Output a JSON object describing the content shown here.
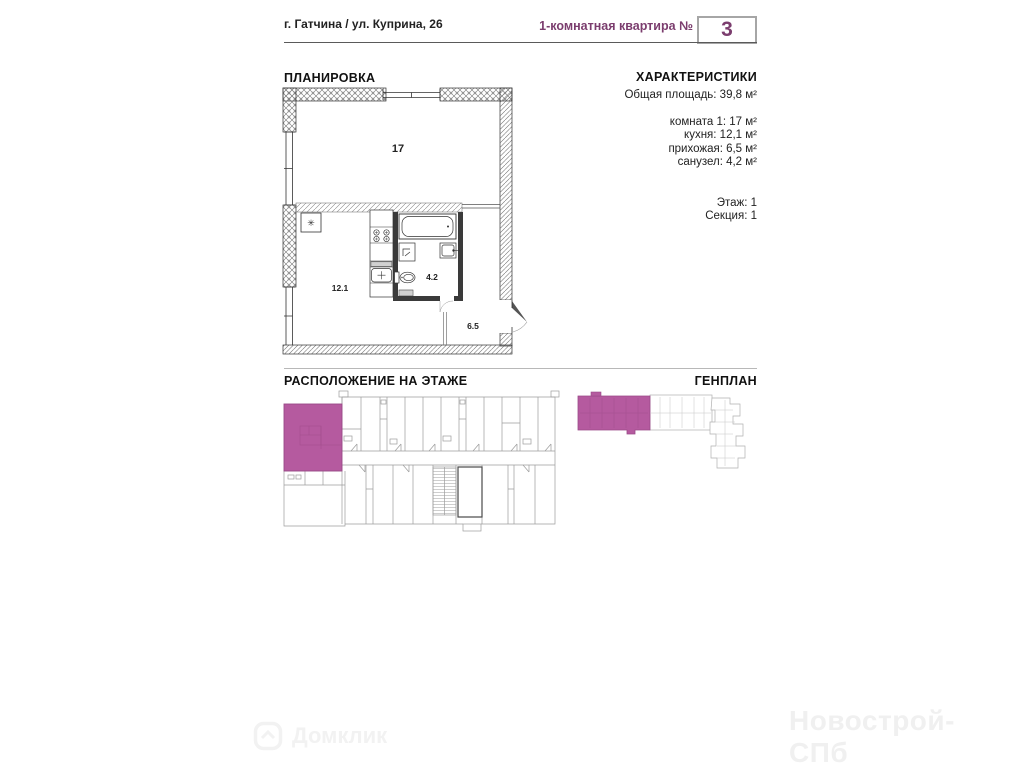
{
  "header": {
    "address": "г. Гатчина / ул. Куприна, 26",
    "apartment_type_label": "1-комнатная квартира №",
    "apartment_number": "3"
  },
  "plan": {
    "title": "ПЛАНИРОВКА",
    "room_labels": {
      "room": "17",
      "kitchen": "12.1",
      "bathroom": "4.2",
      "hallway": "6.5"
    }
  },
  "characteristics": {
    "title": "ХАРАКТЕРИСТИКИ",
    "total_area": "Общая площадь: 39,8 м²",
    "rooms": [
      "комната 1: 17 м²",
      "кухня: 12,1 м²",
      "прихожая: 6,5 м²",
      "санузел: 4,2 м²"
    ],
    "floor": "Этаж: 1",
    "section": "Секция: 1"
  },
  "floor_location": {
    "title": "РАСПОЛОЖЕНИЕ НА ЭТАЖЕ"
  },
  "genplan": {
    "title": "ГЕНПЛАН"
  },
  "watermarks": {
    "left": "Домклик",
    "right": "Новострой-СПб"
  },
  "colors": {
    "accent": "#7b3d6e",
    "highlight": "#b55a9f",
    "plan_lines": "#333333",
    "light_lines": "#9d9d9d"
  }
}
